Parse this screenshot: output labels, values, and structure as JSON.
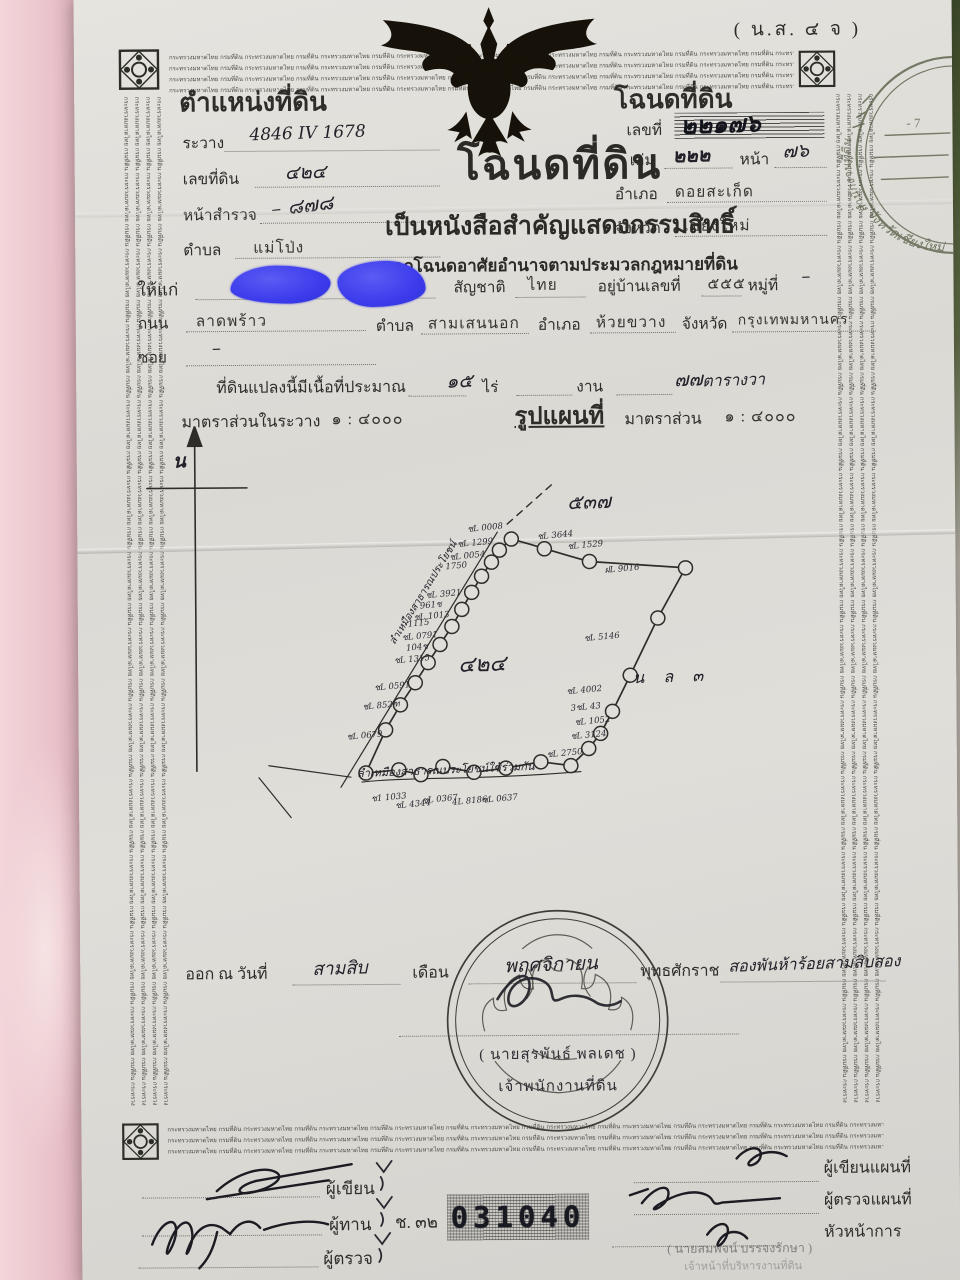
{
  "form_code": "( น.ส. ๔ จ )",
  "border": {
    "pattern_text": "กระทรวงมหาดไทย กรมที่ดิน "
  },
  "colors": {
    "redaction_blue": "#3c3cec",
    "paper": "#dcdad5",
    "ink": "#2b2a27",
    "stamp_green": "#5a6149"
  },
  "position_block": {
    "title": "ตำแหน่งที่ดิน",
    "rawang_label": "ระวาง",
    "rawang_value": "4846 IV 1678",
    "parcel_label": "เลขที่ดิน",
    "parcel_value": "๔๒๔",
    "survey_label": "หน้าสำรวจ",
    "survey_value": "–  ๘๗๘",
    "tambon_label": "ตำบล",
    "tambon_value": "แม่โป่ง"
  },
  "deed_block": {
    "title": "โฉนดที่ดิน",
    "number_label": "เลขที่",
    "number_value": "๒๒๑๗๖",
    "volume_label": "เล่ม",
    "volume_value": "๒๒๒",
    "page_label": "หน้า",
    "page_value": "๗๖",
    "amphoe_label": "อำเภอ",
    "amphoe_value": "ดอยสะเก็ด",
    "province_label": "จังหวัด",
    "province_value": "เชียงใหม่"
  },
  "stamp": {
    "office": "สำนักงานที่ดิน",
    "province": "จังหวัดเชียงใหม่",
    "date_fragment": "- 7"
  },
  "title_block": {
    "main": "โฉนดที่ดิน",
    "sub1": "เป็นหนังสือสำคัญแสดงกรรมสิทธิ์",
    "sub2": "ออกโฉนดอาศัยอำนาจตามประมวลกฎหมายที่ดิน"
  },
  "grantee": {
    "to_label": "ให้แก่",
    "nationality_label": "สัญชาติ",
    "nationality_value": "ไทย",
    "address_label": "อยู่บ้านเลขที่",
    "address_value": "๕๕๕",
    "moo_label": "หมู่ที่",
    "moo_value": "–",
    "road_label": "ถนน",
    "road_value": "ลาดพร้าว",
    "tambon_label": "ตำบล",
    "tambon_value": "สามเสนนอก",
    "amphoe_label": "อำเภอ",
    "amphoe_value": "ห้วยขวาง",
    "province_label": "จังหวัด",
    "province_value": "กรุงเทพมหานคร",
    "soi_label": "ซอย",
    "soi_value": "–"
  },
  "area": {
    "prefix": "ที่ดินแปลงนี้มีเนื้อที่ประมาณ",
    "rai_value": "๑๕",
    "rai_label": "ไร่",
    "ngan_value": "",
    "ngan_label": "งาน",
    "wa_value": "๗๗",
    "wa_label": "ตารางวา"
  },
  "scale": {
    "left_label": "มาตราส่วนในระวาง",
    "left_value": "๑ : ๔๐๐๐",
    "center": "รูปแผนที่",
    "right_label": "มาตราส่วน",
    "right_value": "๑ : ๔๐๐๐"
  },
  "map": {
    "north_label": "น",
    "plot_number": "๔๒๔",
    "neighbor_top": "๕๓๗",
    "neighbor_right": "น ล ๓",
    "left_road_text": "ลำเหมืองสาธารณประโยชน์",
    "bottom_road_text": "ลำเหมืองสาธารณประโยชน์ใช้ร่วมกัน",
    "labels": [
      {
        "t": "ชL 0008",
        "x": 350,
        "y": 96
      },
      {
        "t": "ชL 1299",
        "x": 340,
        "y": 111
      },
      {
        "t": "ชL 0054",
        "x": 332,
        "y": 124
      },
      {
        "t": "1750",
        "x": 328,
        "y": 137
      },
      {
        "t": "ชL 3921",
        "x": 308,
        "y": 162
      },
      {
        "t": "961ช",
        "x": 302,
        "y": 173
      },
      {
        "t": "ชL 1013",
        "x": 296,
        "y": 184
      },
      {
        "t": "1115",
        "x": 290,
        "y": 194
      },
      {
        "t": "ชL 0791",
        "x": 284,
        "y": 204
      },
      {
        "t": "104ช",
        "x": 288,
        "y": 215
      },
      {
        "t": "ชL 1315",
        "x": 276,
        "y": 227
      },
      {
        "t": "ชL 0591",
        "x": 256,
        "y": 254
      },
      {
        "t": "ชL 852ฑ",
        "x": 244,
        "y": 273
      },
      {
        "t": "ชL 0679",
        "x": 228,
        "y": 303
      },
      {
        "t": "ช1 1033",
        "x": 252,
        "y": 365
      },
      {
        "t": "ชL 4344",
        "x": 276,
        "y": 372
      },
      {
        "t": "ชL 0367",
        "x": 303,
        "y": 367
      },
      {
        "t": "4L 8186",
        "x": 333,
        "y": 372
      },
      {
        "t": "ชL 0637",
        "x": 363,
        "y": 367
      },
      {
        "t": "ชL 3644",
        "x": 420,
        "y": 104
      },
      {
        "t": "ชL 1529",
        "x": 450,
        "y": 114
      },
      {
        "t": "ฝL 9016",
        "x": 487,
        "y": 138
      },
      {
        "t": "ชL 5146",
        "x": 466,
        "y": 206
      },
      {
        "t": "ชL 4002",
        "x": 448,
        "y": 259
      },
      {
        "t": "3ชL 43",
        "x": 452,
        "y": 276
      },
      {
        "t": "ชL 1052",
        "x": 456,
        "y": 290
      },
      {
        "t": "ชL 3124",
        "x": 452,
        "y": 304
      },
      {
        "t": "ชL 2750",
        "x": 428,
        "y": 322
      }
    ]
  },
  "issue": {
    "prefix": "ออก ณ วันที่",
    "day": "สามสิบ",
    "month_label": "เดือน",
    "month": "พฤศจิกายน",
    "era_label": "พุทธศักราช",
    "year": "สองพันห้าร้อยสามสิบสอง"
  },
  "seal": {
    "officer": "( นายสุรพันธ์  พลเดช )",
    "officer_title": "เจ้าพนักงานที่ดิน"
  },
  "footer": {
    "writer": "ผู้เขียน",
    "checker": "ผู้ทาน",
    "examiner": "ผู้ตรวจ",
    "batch": "ช. ๓๒",
    "serial": "031040",
    "map_writer": "ผู้เขียนแผนที่",
    "map_examiner": "ผู้ตรวจแผนที่",
    "chief": "หัวหน้าการ",
    "faint_name": "( นายสมพจน์  บรรจงรักษา )",
    "faint_title": "เจ้าหน้าที่บริหารงานที่ดิน"
  }
}
